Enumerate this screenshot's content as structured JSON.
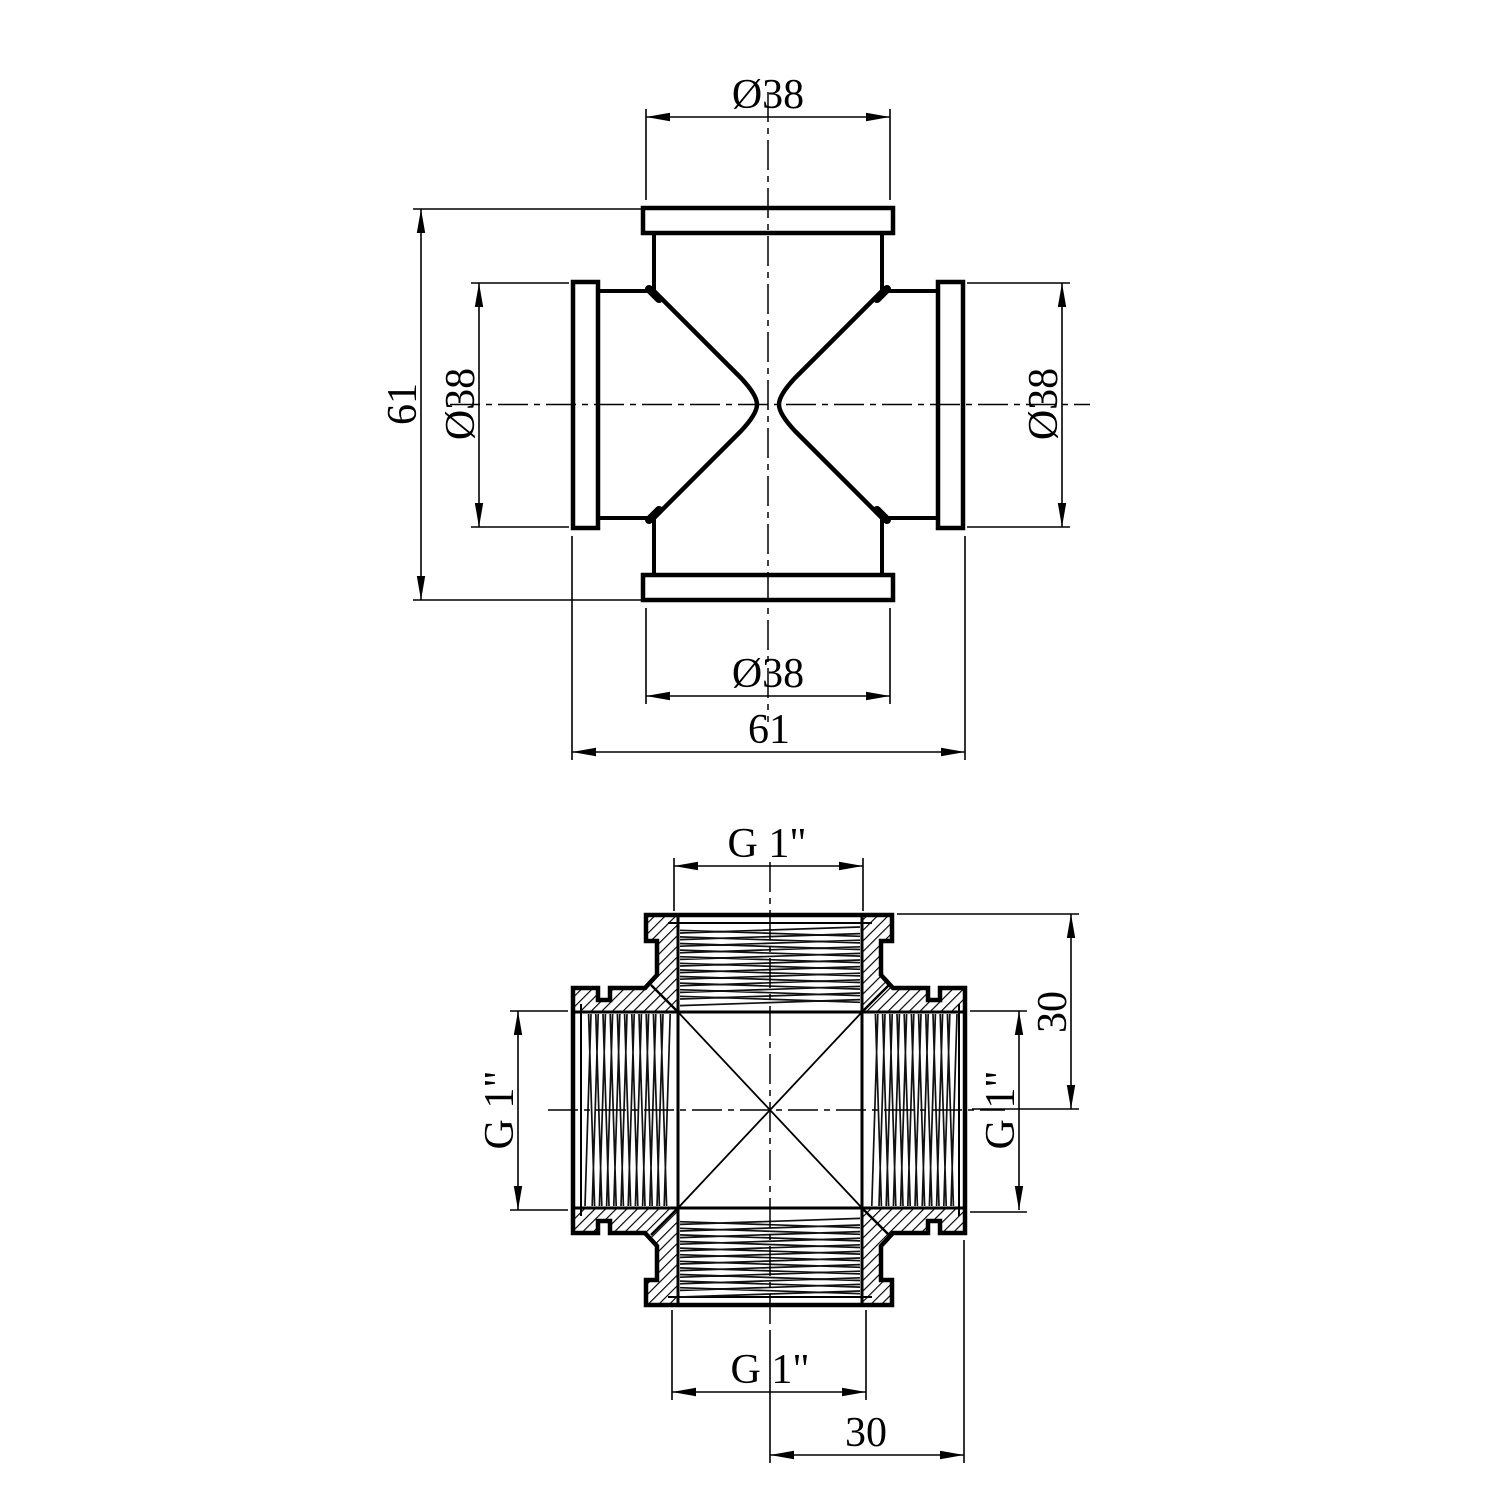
{
  "drawing": {
    "top_view": {
      "dims": {
        "port_diameter_top": "Ø38",
        "port_diameter_left": "Ø38",
        "port_diameter_right": "Ø38",
        "port_diameter_bottom": "Ø38",
        "overall_height": "61",
        "overall_width": "61"
      }
    },
    "section_view": {
      "dims": {
        "thread_size_top": "G 1\"",
        "thread_size_left": "G 1\"",
        "thread_size_right": "G 1\"",
        "thread_size_bottom": "G 1\"",
        "port_depth_right": "30",
        "port_depth_bottom": "30"
      }
    }
  }
}
